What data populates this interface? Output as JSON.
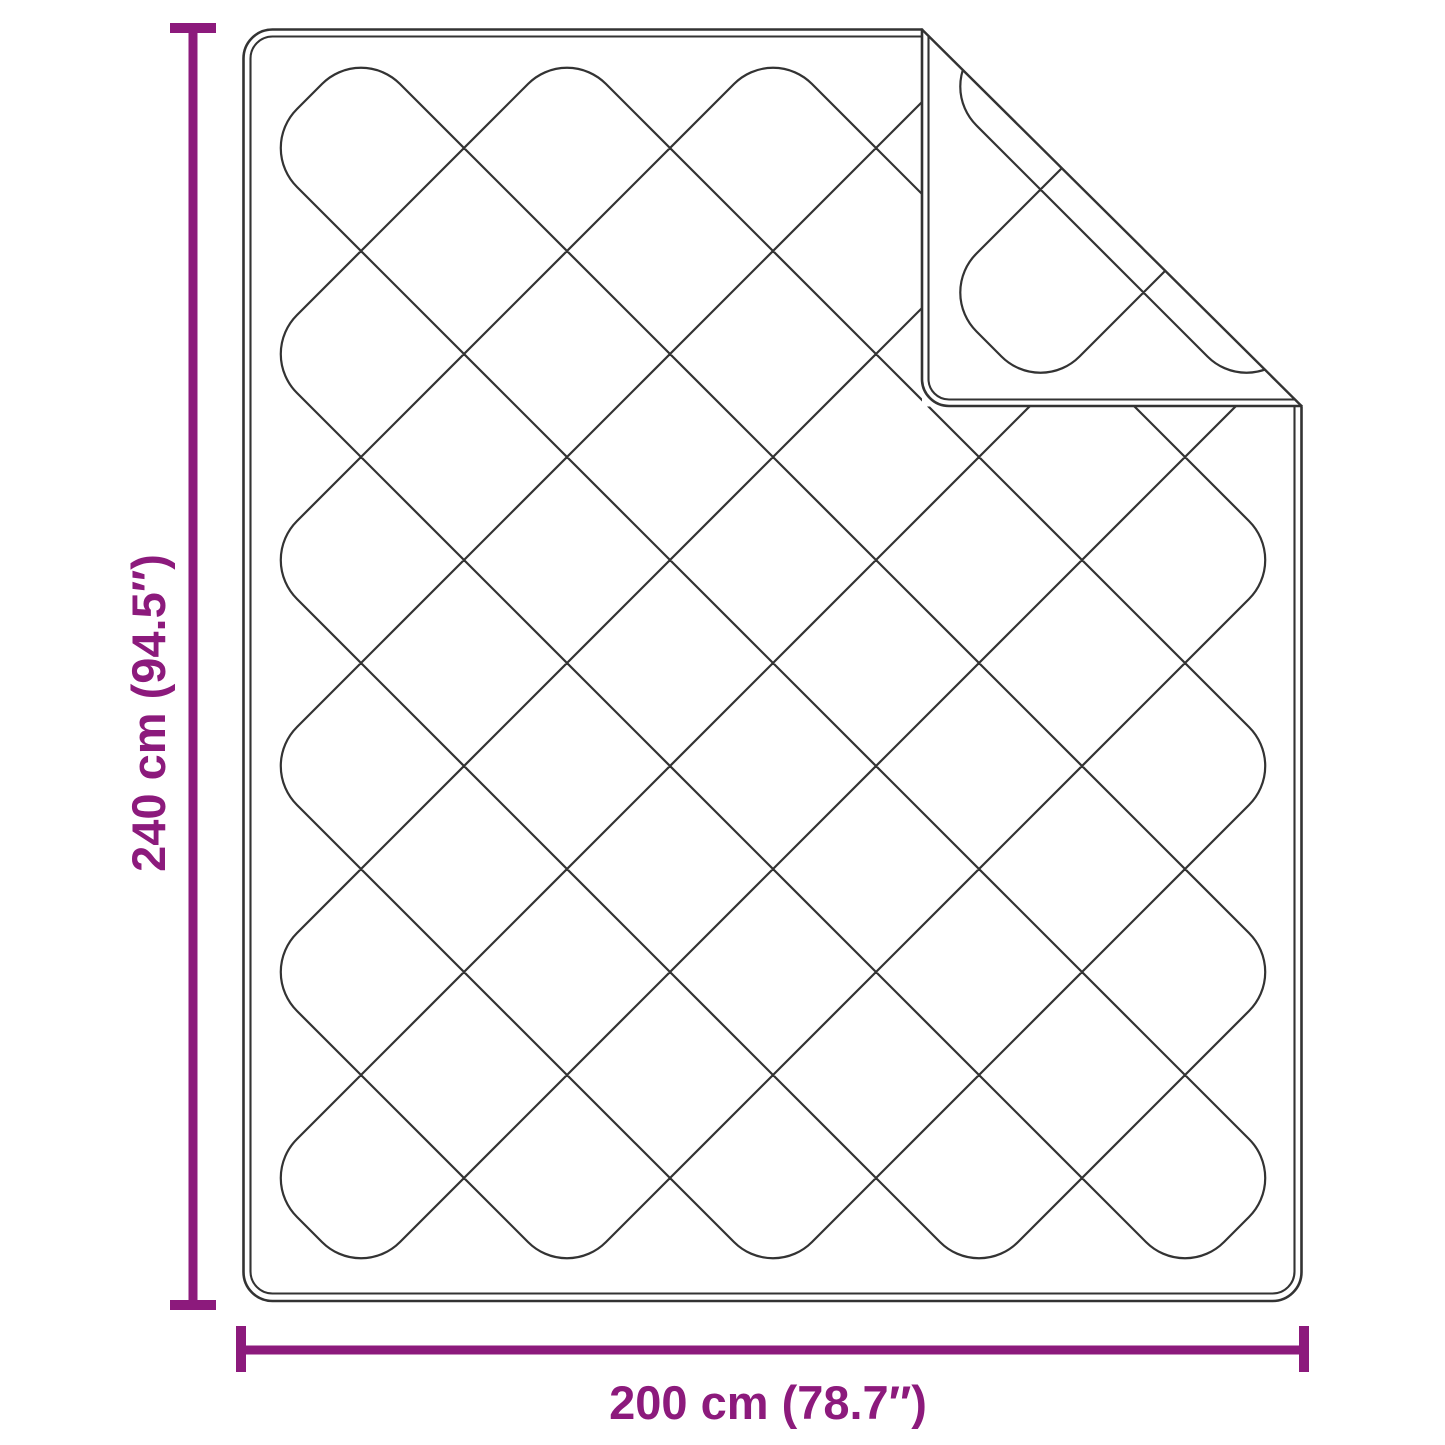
{
  "diagram": {
    "type": "product-dimension-diagram",
    "subject": "quilted-blanket-with-folded-corner",
    "height_dimension": {
      "label": "240 cm (94.5″)",
      "value_cm": 240,
      "value_inches": 94.5,
      "orientation": "vertical"
    },
    "width_dimension": {
      "label": "200 cm (78.7″)",
      "value_cm": 200,
      "value_inches": 78.7,
      "orientation": "horizontal"
    },
    "colors": {
      "accent": "#8C1A7C",
      "outline": "#333333",
      "background": "#FFFFFF"
    }
  }
}
